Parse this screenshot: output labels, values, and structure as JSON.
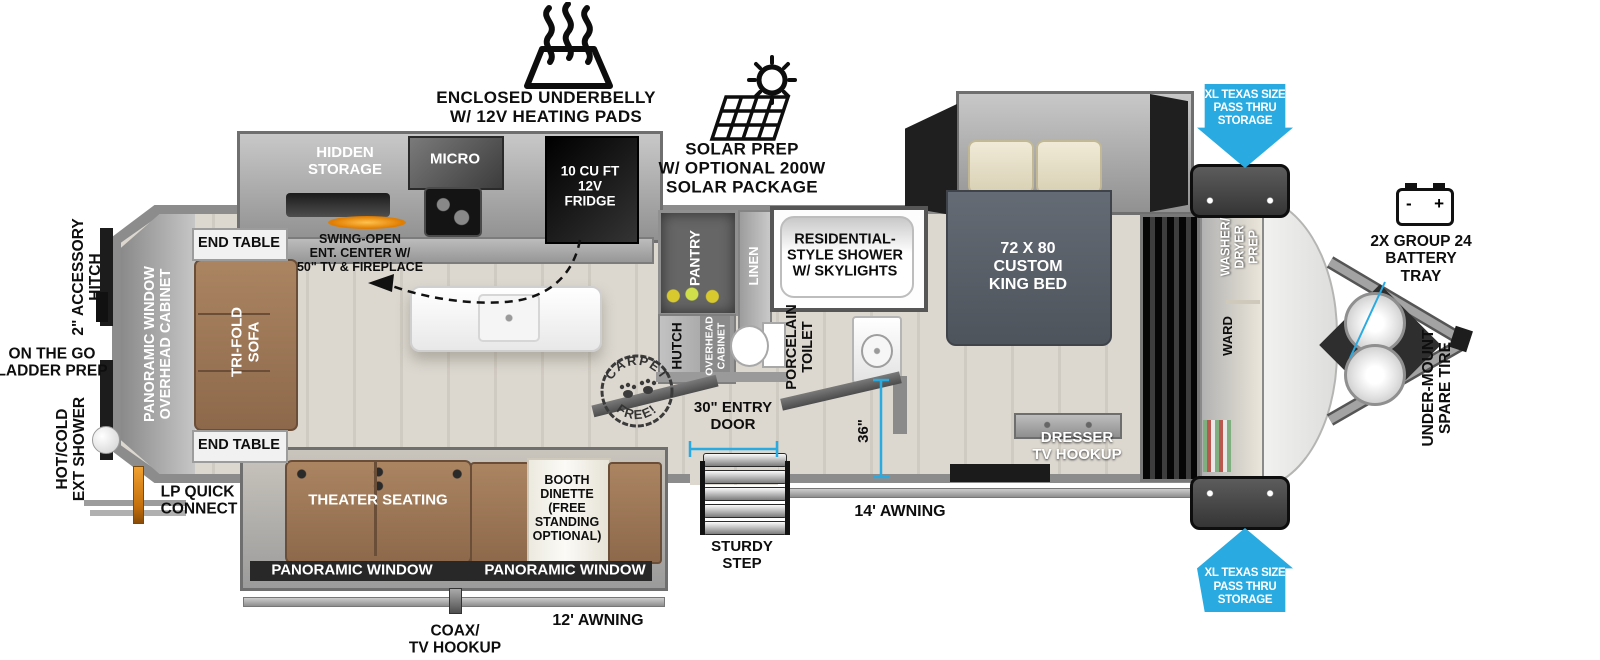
{
  "colors": {
    "accent_blue": "#29ABE2",
    "wall_gray": "#8C8C8C",
    "floor_wood": "#DBD6CE",
    "furniture_brown": "#A07A58",
    "bed_gray": "#59616C",
    "black_fixture": "#141414"
  },
  "labels": {
    "underbelly": "ENCLOSED UNDERBELLY\nW/ 12V HEATING PADS",
    "solar": "SOLAR PREP\nW/ OPTIONAL 200W\nSOLAR PACKAGE",
    "pass_thru": "XL TEXAS SIZE\nPASS THRU\nSTORAGE",
    "battery": "2X GROUP 24\nBATTERY\nTRAY",
    "battery_minus": "-",
    "battery_plus": "+",
    "spare_tire": "UNDER-MOUNT\nSPARE TIRE",
    "accessory_hitch": "2\" ACCESSORY\nHITCH",
    "ladder_prep": "ON THE GO\nLADDER PREP",
    "ext_shower": "HOT/COLD\nEXT SHOWER",
    "lp_connect": "LP QUICK\nCONNECT",
    "pan_window_cab": "PANORAMIC WINDOW\nOVERHEAD CABINET",
    "end_table": "END TABLE",
    "sofa": "TRI-FOLD\nSOFA",
    "hidden_storage": "HIDDEN\nSTORAGE",
    "micro": "MICRO",
    "fridge": "10 CU FT\n12V\nFRIDGE",
    "ent_center": "SWING-OPEN\nENT. CENTER W/\n50\" TV & FIREPLACE",
    "pantry": "PANTRY",
    "linen": "LINEN",
    "shower": "RESIDENTIAL-\nSTYLE SHOWER\nW/ SKYLIGHTS",
    "hutch": "HUTCH",
    "overhead_cabinet": "OVERHEAD\nCABINET",
    "toilet": "PORCELAIN\nTOILET",
    "carpet_top": "CARPET",
    "carpet_bottom": "FREE!",
    "bed": "72 X 80\nCUSTOM\nKING BED",
    "dresser": "DRESSER\nTV HOOKUP",
    "washer_dryer": "WASHER/\nDRYER\nPREP",
    "ward": "WARD",
    "theater": "THEATER SEATING",
    "dinette": "BOOTH\nDINETTE\n(FREE\nSTANDING\nOPTIONAL)",
    "pan_window": "PANORAMIC WINDOW",
    "entry_door": "30\" ENTRY\nDOOR",
    "sturdy_step": "STURDY\nSTEP",
    "awning14": "14' AWNING",
    "awning12": "12' AWNING",
    "coax": "COAX/\nTV HOOKUP",
    "dim36": "36\""
  },
  "dimensions": {
    "entry_door_width": "30\"",
    "hall_width": "36\"",
    "main_awning": "14'",
    "slide_awning": "12'"
  }
}
